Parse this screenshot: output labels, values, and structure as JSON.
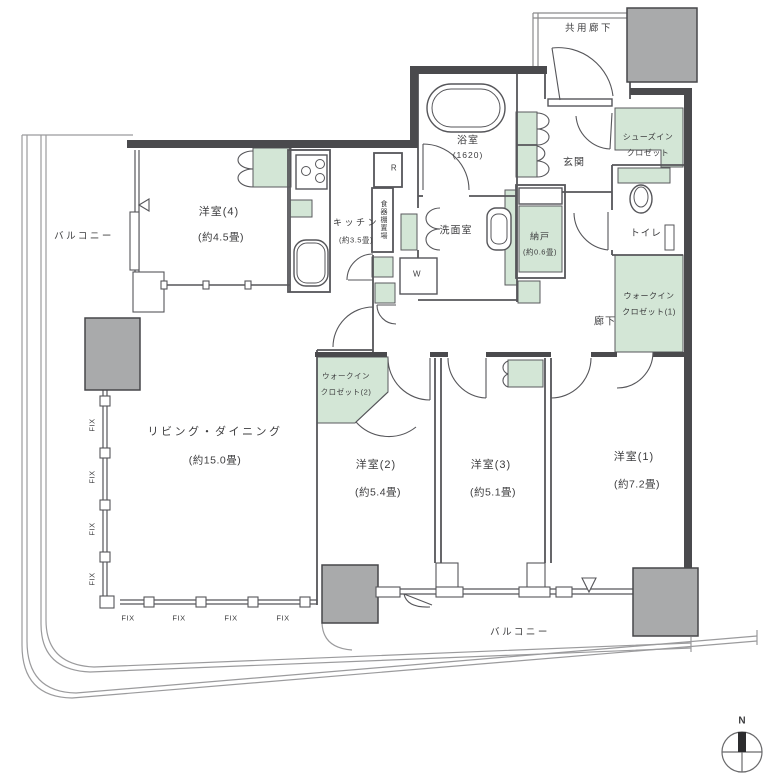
{
  "floorplan": {
    "colors": {
      "closet_green": "#d3e6d6",
      "pillar_gray": "#a9aaab"
    },
    "labels": {
      "common_corridor": "共用廊下",
      "entrance": "玄関",
      "hallway": "廊下",
      "toilet": "トイレ",
      "washroom": "洗面室",
      "refrigerator_mark": "R",
      "washer_mark": "W",
      "cupboard_space": "食器棚置場",
      "balcony_left": "バルコニー",
      "balcony_bottom": "バルコニー",
      "fix_window": "FIX",
      "north_mark": "N"
    },
    "rooms": {
      "bedroom4": {
        "name": "洋室(4)",
        "size": "(約4.5畳)"
      },
      "kitchen": {
        "name": "キッチン",
        "size": "(約3.5畳)"
      },
      "bathroom": {
        "name": "浴室",
        "size": "(1620)"
      },
      "storeroom": {
        "name": "納戸",
        "size": "(約0.6畳)"
      },
      "living_dining": {
        "name": "リビング・ダイニング",
        "size": "(約15.0畳)"
      },
      "bedroom2": {
        "name": "洋室(2)",
        "size": "(約5.4畳)"
      },
      "bedroom3": {
        "name": "洋室(3)",
        "size": "(約5.1畳)"
      },
      "bedroom1": {
        "name": "洋室(1)",
        "size": "(約7.2畳)"
      },
      "shoes_in_closet": {
        "line1": "シューズイン",
        "line2": "クロゼット"
      },
      "walk_in_closet1": {
        "line1": "ウォークイン",
        "line2": "クロゼット(1)"
      },
      "walk_in_closet2": {
        "line1": "ウォークイン",
        "line2": "クロゼット(2)"
      }
    }
  }
}
